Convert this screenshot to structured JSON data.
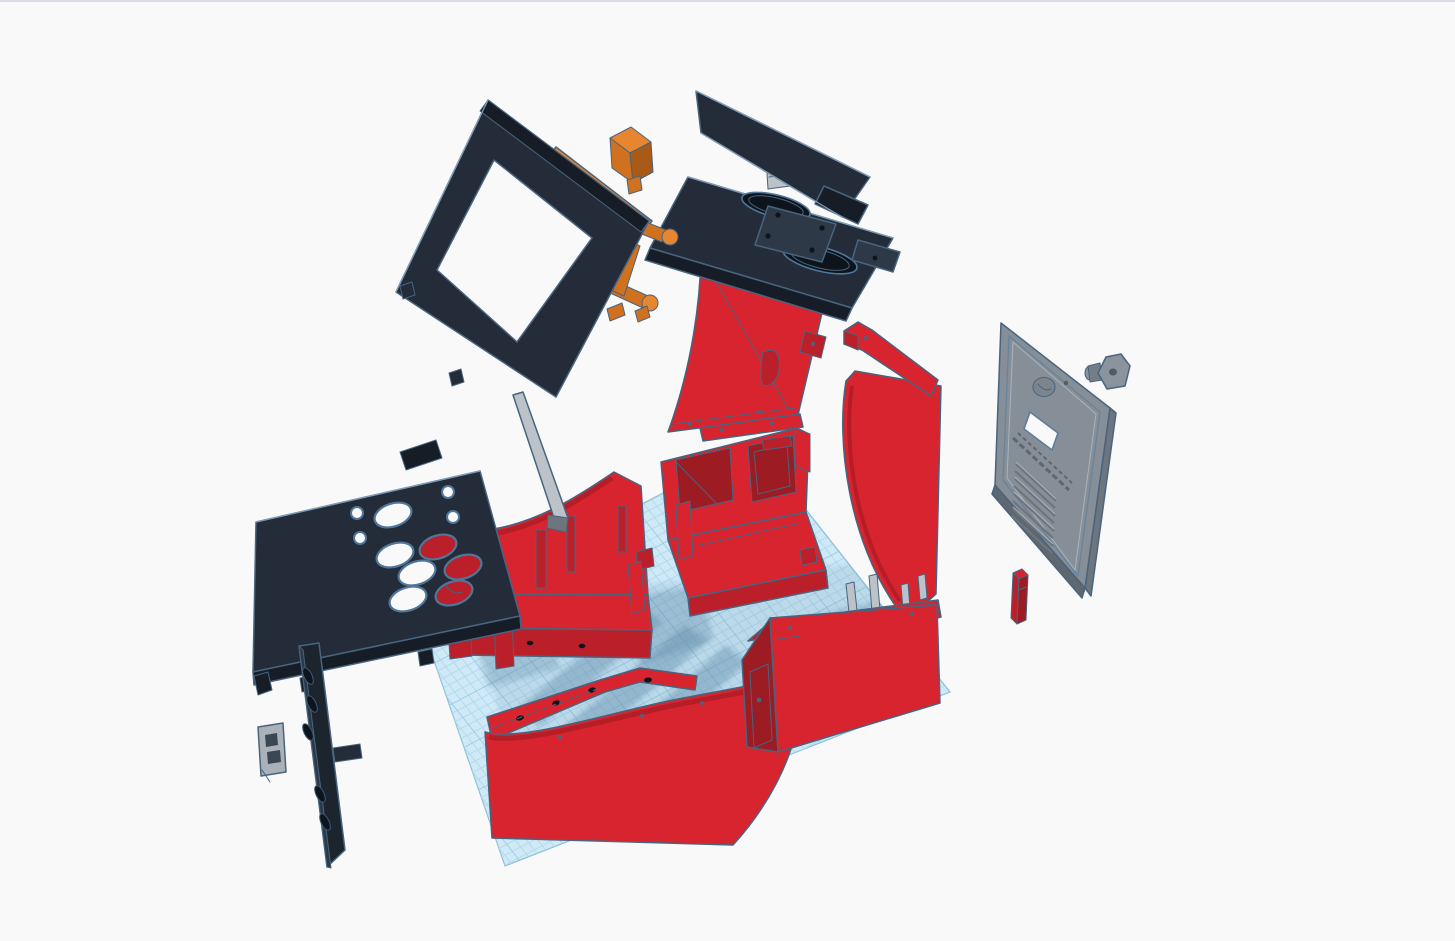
{
  "app": {
    "description": "3D design viewport showing an exploded arcade cabinet kit",
    "visible_text": "none (embossed text on rear door is illegible)"
  },
  "colors": {
    "bg": "#f9f9fa",
    "topline": "#d9dbe9",
    "plane": "#cfe9f7",
    "gridMinor": "#b3daee",
    "gridMajor": "#8fc6e0",
    "planeEdge": "#8fc0da",
    "shadow": "#5e8aa8",
    "redHi": "#d8242f",
    "redMid": "#bb1f29",
    "redLo": "#9d1b23",
    "ink": "#232c38",
    "inkHi": "#2e3947",
    "inkLo": "#161d26",
    "inkHole": "#0d141c",
    "orHi": "#e album",
    "orHi2": "#e7862f",
    "orMid": "#d0711f",
    "orLo": "#a85a16",
    "gray": "#868e97",
    "grayLt": "#aab1b9",
    "grayDk": "#6d757e",
    "stick": "#bcc2c8",
    "edge": "#48647f",
    "edgeLt": "#7e9cb8"
  },
  "workplane": {
    "label": "Workplane grid",
    "grid_minor_px": 9,
    "grid_major_every": 5,
    "color": "#cfe9f7"
  },
  "parts": [
    {
      "id": "workplane",
      "label": "Workplane grid",
      "color": "#cfe9f7"
    },
    {
      "id": "screen-bezel",
      "label": "Screen bezel frame",
      "color": "#232c38"
    },
    {
      "id": "monitor-frame",
      "label": "Monitor mounting frame & legs",
      "color": "#e7862f"
    },
    {
      "id": "orange-block",
      "label": "Small orange block",
      "color": "#e7862f"
    },
    {
      "id": "marquee-panel",
      "label": "Marquee top panel",
      "color": "#232c38"
    },
    {
      "id": "speaker-deck",
      "label": "Speaker deck panel",
      "color": "#232c38"
    },
    {
      "id": "left-side-panel",
      "label": "Left side panel",
      "color": "#d8242f"
    },
    {
      "id": "right-side-panel",
      "label": "Right side panel",
      "color": "#d8242f"
    },
    {
      "id": "side-top-bracket",
      "label": "Side panel top bracket",
      "color": "#d8242f"
    },
    {
      "id": "left-tray",
      "label": "Left base tray",
      "color": "#d8242f"
    },
    {
      "id": "center-box",
      "label": "Center base box",
      "color": "#d8242f"
    },
    {
      "id": "front-left-panel",
      "label": "Front curved kick panel",
      "color": "#d8242f"
    },
    {
      "id": "front-right-box",
      "label": "Front right box",
      "color": "#d8242f"
    },
    {
      "id": "front-bracket-bar",
      "label": "Front bracket bar",
      "color": "#d8242f"
    },
    {
      "id": "control-panel",
      "label": "Control panel with button holes",
      "color": "#232c38"
    },
    {
      "id": "vent-strip",
      "label": "Vent strip",
      "color": "#1c242e"
    },
    {
      "id": "corner-clip",
      "label": "Corner clip",
      "color": "#9aa1aa"
    },
    {
      "id": "support-stick",
      "label": "Support stick",
      "color": "#bcc2c8"
    },
    {
      "id": "rear-door",
      "label": "Rear access door with vents",
      "color": "#868e97"
    },
    {
      "id": "lock-latch",
      "label": "Lock latch & barrel",
      "color": "#8b939c"
    },
    {
      "id": "door-stop",
      "label": "Door stop block",
      "color": "#d8242f"
    },
    {
      "id": "support-pegs",
      "label": "Support pegs",
      "color": "#b0b6bc"
    },
    {
      "id": "small-red-posts",
      "label": "Small red posts",
      "color": "#d8242f"
    }
  ]
}
